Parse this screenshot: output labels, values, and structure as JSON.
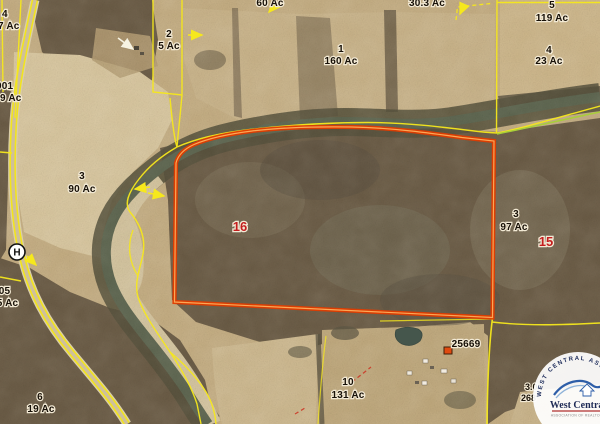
{
  "map": {
    "route_marker": "H",
    "address_label": "25669",
    "section_numbers": {
      "sec16": "16",
      "sec15": "15"
    },
    "parcel_labels": {
      "top_cut_left_ac": "60 Ac",
      "top_cut_right_ac": "30.3 Ac",
      "tl_num": "4",
      "tl_ac": "7 Ac",
      "l001_num": "001",
      "l001_ac": "9 Ac",
      "p2_num": "2",
      "p2_ac": "5 Ac",
      "p1_num": "1",
      "p1_ac": "160 Ac",
      "p5_num": "5",
      "p5_ac": "119 Ac",
      "p4_num": "4",
      "p4_ac": "23 Ac",
      "p3_num": "3",
      "p3_ac": "90 Ac",
      "r3_num": "3",
      "r3_ac": "97 Ac",
      "l105_num": "105",
      "l105_ac": "55 Ac",
      "p6_num": "6",
      "p6_ac": "19 Ac",
      "p10_num": "10",
      "p10_ac": "131 Ac",
      "br_num": "3.0",
      "br_ac": "268"
    },
    "colors": {
      "boundary_yellow": "#f6e81c",
      "boundary_green": "#a8cf3a",
      "highlight_parcel_red": "#e03c00",
      "section_number_red": "#c41e1e",
      "label_black": "#171007",
      "river": "#5d654f",
      "field_tan": "#c9b389"
    }
  },
  "logo": {
    "arc_text": "WEST CENTRAL ASSOCIATION OF REALTORS",
    "name": "West Central",
    "sub_text": "ASSOCIATION OF REALTORS"
  }
}
